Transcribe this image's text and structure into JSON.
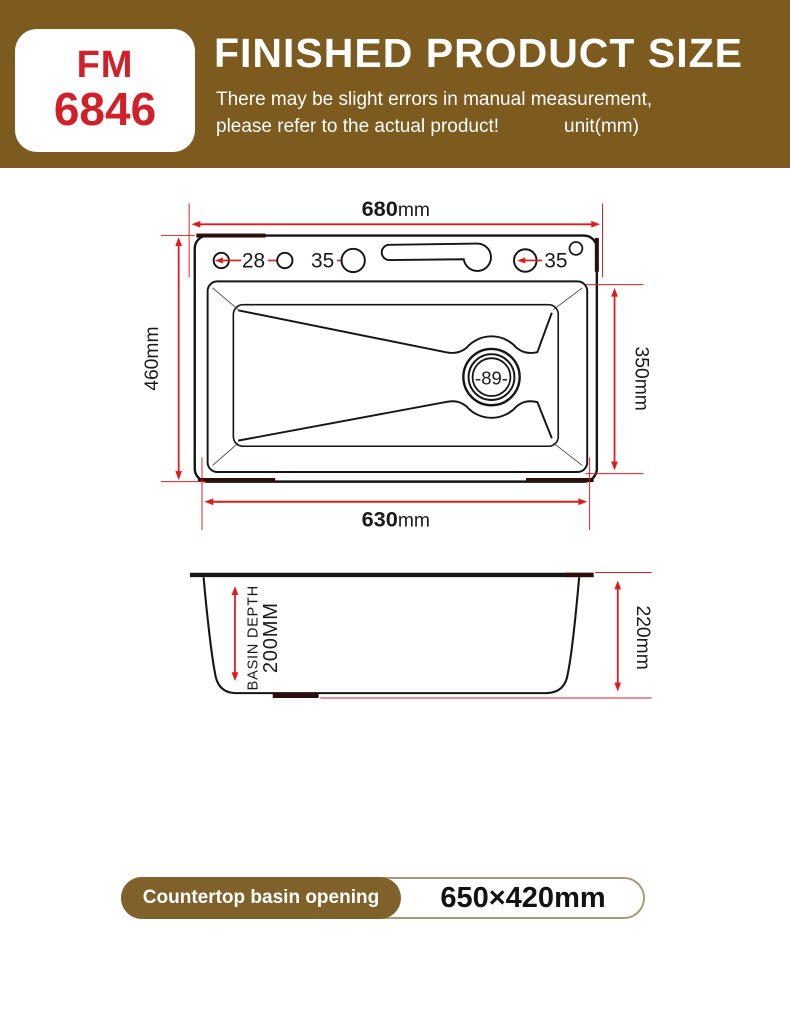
{
  "header": {
    "model_top": "FM",
    "model_bottom": "6846",
    "title": "FINISHED PRODUCT SIZE",
    "subtitle_line1": "There may be slight errors in manual measurement,",
    "subtitle_line2": "please refer to the actual product!",
    "unit_label": "unit(mm)"
  },
  "top_view": {
    "dim_top": {
      "value": "680",
      "unit": "mm"
    },
    "dim_bottom": {
      "value": "630",
      "unit": "mm"
    },
    "dim_left": "460mm",
    "dim_right": "350mm",
    "holes": [
      "28",
      "35",
      "35"
    ],
    "drain_diameter": "-89-"
  },
  "side_view": {
    "depth_label_line1": "BASIN DEPTH",
    "depth_label_line2": "200MM",
    "dim_right": "220mm"
  },
  "footer": {
    "badge_label": "Countertop basin opening",
    "badge_value": "650×420mm"
  },
  "colors": {
    "brand_brown": "#7d5a1e",
    "badge_brown": "#81612a",
    "logo_red": "#d2202a",
    "dimension_red": "#e01b1b",
    "accent_maroon": "#2e0d0d"
  }
}
